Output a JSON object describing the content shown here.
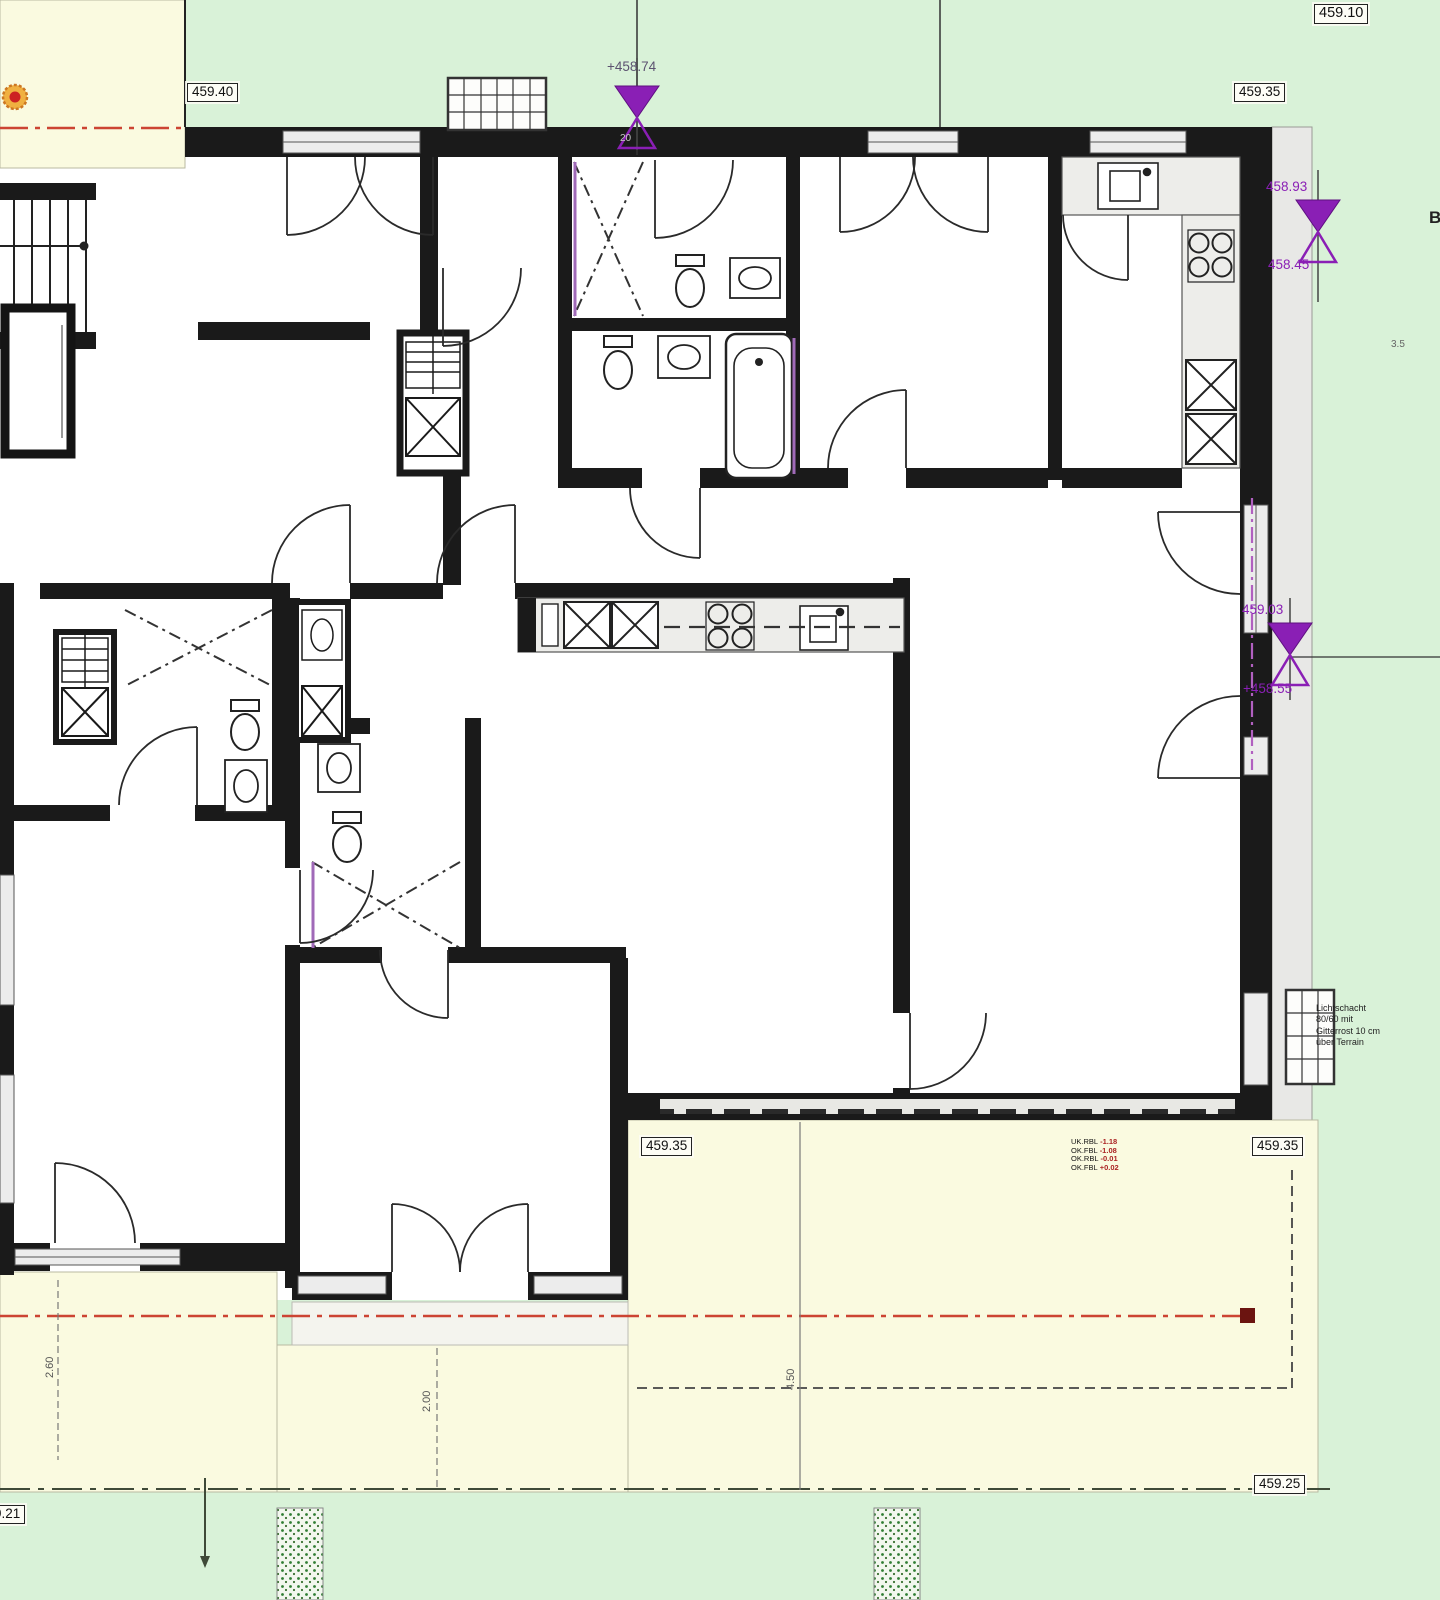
{
  "title": "Floor plan drawing (ground floor) with site levels",
  "colors": {
    "site_green": "#d9f2d8",
    "terrace_yellow": "#fafae0",
    "wall": "#1a1a1a",
    "marker_purple": "#8a1fb5",
    "label_purple": "#7b1fa2",
    "boundary_red": "#cc4433",
    "planting_green": "#2f7d32"
  },
  "elevation_labels": {
    "top_left": "459.40",
    "top_right_outer": "459.10",
    "top_right_inner": "459.35",
    "terrace_left": "459.35",
    "terrace_right": "459.35",
    "terrace_bottom_right": "459.25",
    "bottom_left": "459.21"
  },
  "level_markers": {
    "top": {
      "value": "+458.74",
      "wall_dim": "20"
    },
    "right_upper": {
      "above": "458.93",
      "below": "458.45"
    },
    "right_mid": {
      "above": "459.03",
      "below": "+458.55"
    }
  },
  "dimensions": {
    "left_vertical": "2.60",
    "middle_vertical": "2.00",
    "terrace_vertical": "4.50",
    "right_edge": "3.5"
  },
  "section_marker": "B",
  "annotations": {
    "lichtschacht": {
      "line1": "Lichtschacht",
      "line2": "80/60 mit",
      "line3": "Gitterrost 10 cm",
      "line4": "über Terrain"
    },
    "terrace_levels": [
      {
        "label": "UK.RBL",
        "value": "-1.18"
      },
      {
        "label": "OK.FBL",
        "value": "-1.08"
      },
      {
        "label": "OK.RBL",
        "value": "-0.01"
      },
      {
        "label": "OK.FBL",
        "value": "+0.02"
      }
    ]
  }
}
